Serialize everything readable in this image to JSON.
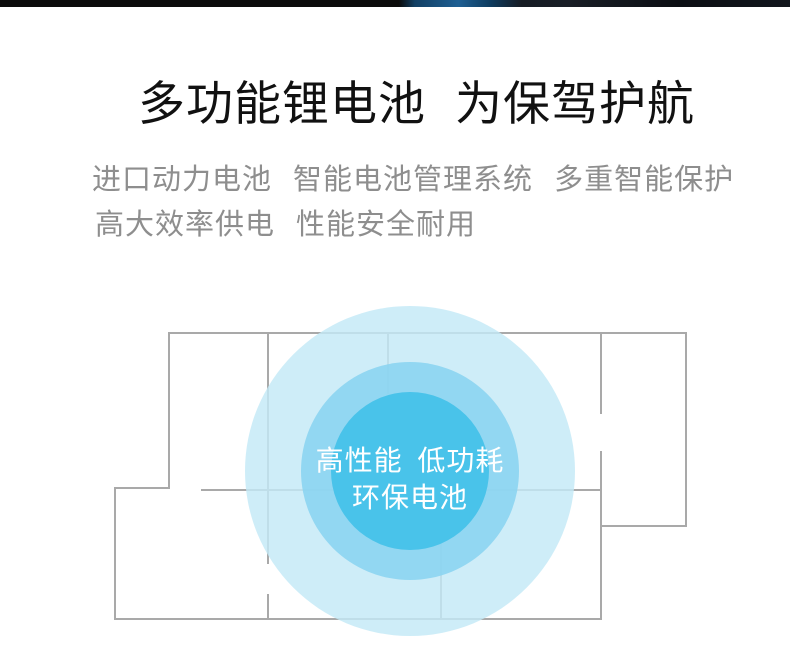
{
  "page": {
    "background_color": "#ffffff"
  },
  "top_strip": {
    "base_color": "#0b0b0b",
    "accent_blue_color": "#1e5f93"
  },
  "header": {
    "title": "多功能锂电池 为保驾护航",
    "title_color": "#111111",
    "subtitle_line1": "进口动力电池 智能电池管理系统 多重智能保护",
    "subtitle_line2": "高大效率供电 性能安全耐用",
    "subtitle_color": "#8e8e8e"
  },
  "floorplan": {
    "wall_color": "#a9a9a9",
    "circle_outer_color": "#c3e9f7",
    "circle_mid_color": "#8ad4f0",
    "circle_inner_color": "#46c2e9",
    "label_line1": "高性能 低功耗",
    "label_line2": "环保电池",
    "label_color": "#ffffff"
  }
}
